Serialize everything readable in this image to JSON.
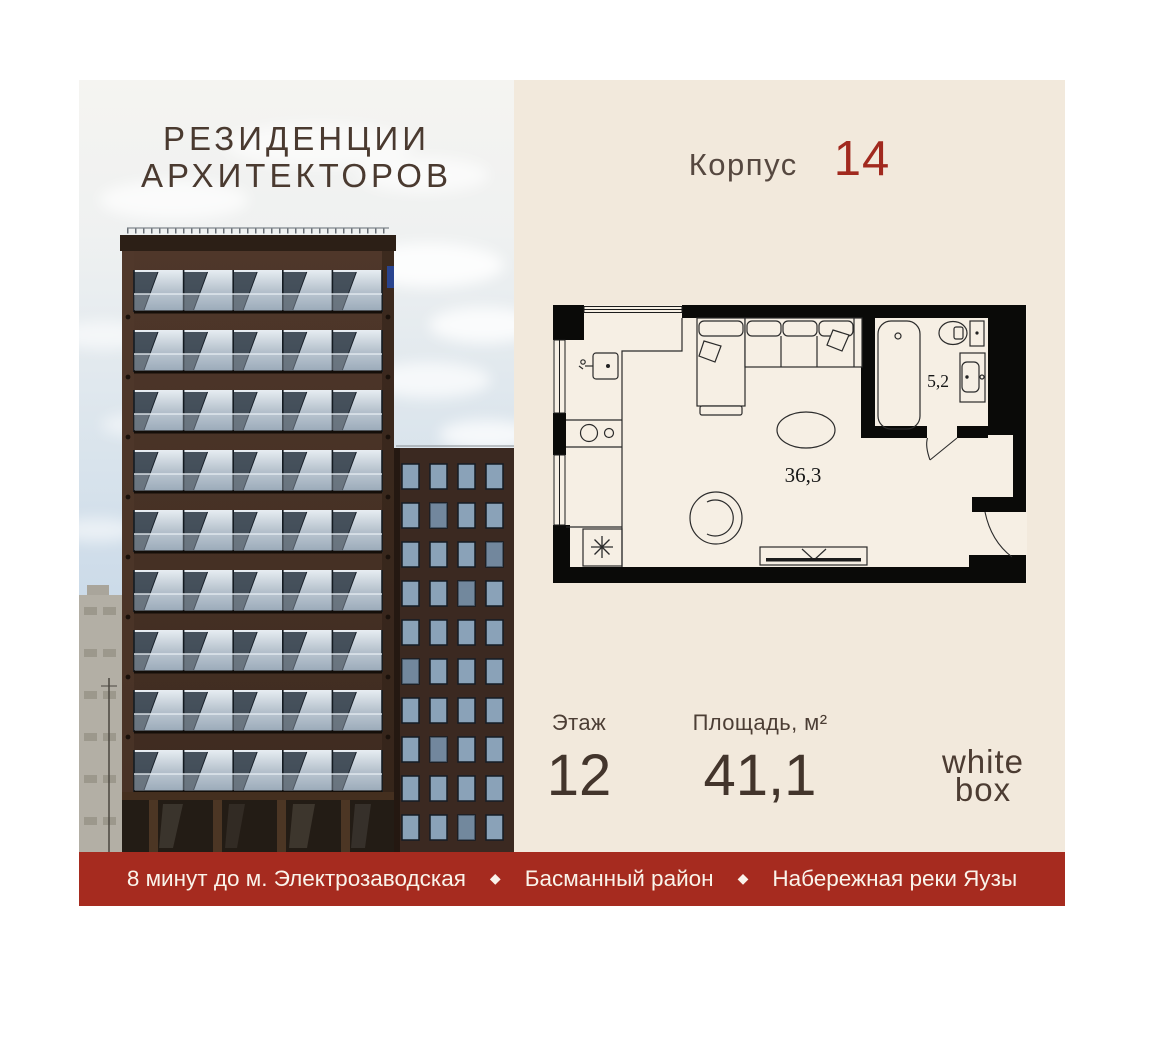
{
  "title": {
    "line1": "РЕЗИДЕНЦИИ",
    "line2": "АРХИТЕКТОРОВ"
  },
  "building": {
    "label": "Корпус",
    "number": "14"
  },
  "plan": {
    "living_area": "36,3",
    "bath_area": "5,2"
  },
  "details": {
    "floor": {
      "label": "Этаж",
      "value": "12"
    },
    "area": {
      "label": "Площадь, м²",
      "value": "41,1"
    },
    "finish": {
      "line1": "white",
      "line2": "box"
    }
  },
  "footer": {
    "separator": "◆",
    "items": [
      "8 минут до м. Электрозаводская",
      "Басманный район",
      "Набережная реки Яузы"
    ]
  },
  "colors": {
    "cream_panel": "#f2e9dc",
    "accent_red_number": "#a1291e",
    "footer_red": "#a62b1f",
    "title_brown": "#4a3a30",
    "plan_wall_black": "#0a0a08"
  }
}
